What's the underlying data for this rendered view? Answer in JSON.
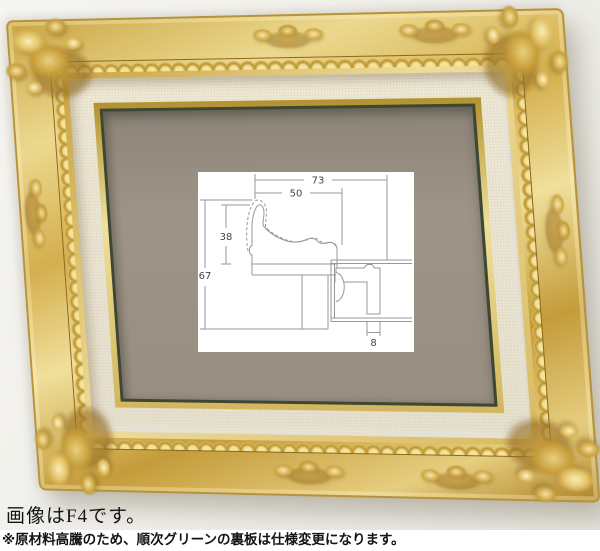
{
  "captions": {
    "image_note": "画像はF4です。",
    "notice": "※原材料高騰のため、順次グリーンの裏板は仕様変更になります。"
  },
  "diagram": {
    "labels": {
      "w73": "73",
      "w50": "50",
      "h38": "38",
      "h67": "67",
      "d8": "8"
    }
  },
  "colors": {
    "wall": "#f1f0ec",
    "frame_gold": "#d4ae4f",
    "frame_gold_light": "#f0df9c",
    "frame_gold_dark": "#a07c24",
    "liner_linen": "#ebe5d5",
    "fillet_gold": "#e3cc79",
    "backboard_edge_green": "#3d4734",
    "board_taupe": "#9a9184",
    "diagram_line": "#97979b",
    "text": "#141414"
  }
}
